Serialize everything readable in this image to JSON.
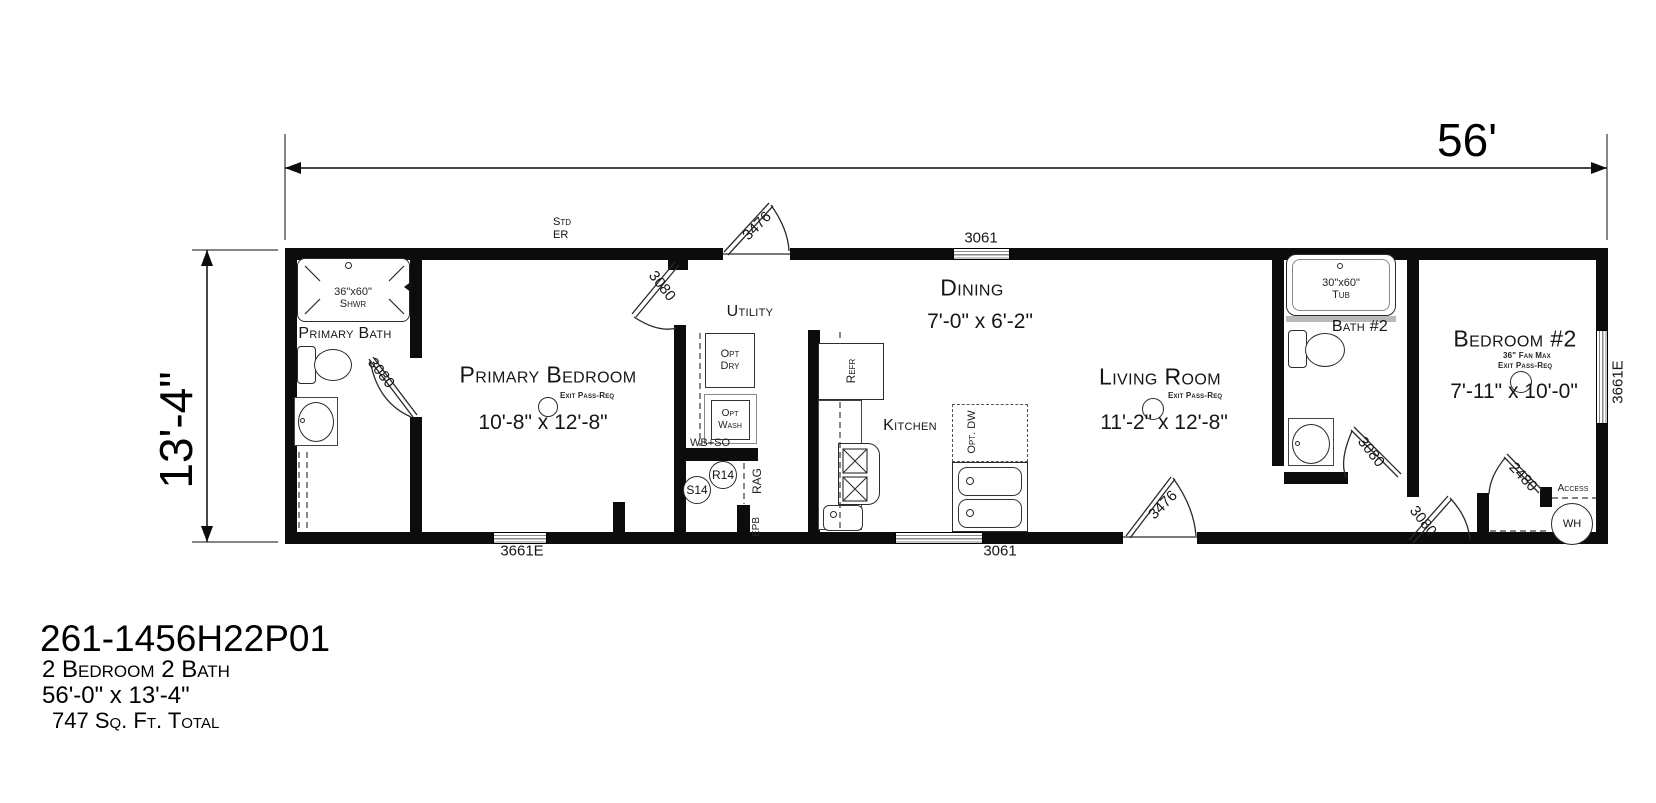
{
  "dimensions": {
    "width": "56'",
    "height": "13'-4\""
  },
  "exterior_notes": {
    "std": "Std",
    "er": "ER"
  },
  "title_block": {
    "model": "261-1456H22P01",
    "beds_baths": "2 Bedroom 2 Bath",
    "size": "56'-0\" x 13'-4\"",
    "area": "747 Sq. Ft. Total"
  },
  "rooms": {
    "primary_bath": {
      "name": "Primary Bath"
    },
    "primary_bedroom": {
      "name": "Primary Bedroom",
      "dims": "10'-8\" x 12'-8\"",
      "note": "Exit Pass-Req"
    },
    "utility": {
      "name": "Utility"
    },
    "kitchen": {
      "name": "Kitchen"
    },
    "dining": {
      "name": "Dining",
      "dims": "7'-0\" x 6'-2\""
    },
    "living_room": {
      "name": "Living Room",
      "dims": "11'-2\" x 12'-8\"",
      "note": "Exit Pass-Req"
    },
    "bath2": {
      "name": "Bath #2"
    },
    "bedroom2": {
      "name": "Bedroom #2",
      "dims": "7'-11\" x 10'-0\"",
      "note_fan": "36\" Fan Max",
      "note_exit": "Exit Pass-Req"
    }
  },
  "fixtures": {
    "shower_size": "36\"x60\"",
    "shower_label": "Shwr",
    "tub_size": "30\"x60\"",
    "tub_label": "Tub",
    "refrigerator": "Refr",
    "opt_dryer": "Opt Dry",
    "opt_washer": "Opt Wash",
    "opt_dishwasher": "Opt. DW",
    "wb_so": "WB+SO",
    "s14": "S14",
    "r14": "R14",
    "rag": "RAG",
    "epb": "EPB",
    "access": "Access",
    "water_heater": "WH"
  },
  "openings": {
    "front_door": "3476",
    "rear_door": "3476",
    "door_primary_bath": "3080",
    "door_primary_bedroom": "3080",
    "door_bath2": "3080",
    "door_bedroom2": "3080",
    "door_wh_closet": "2480",
    "window_dining": "3061",
    "window_rear": "3061",
    "window_front_left": "3661E",
    "window_side_right": "3661E"
  }
}
